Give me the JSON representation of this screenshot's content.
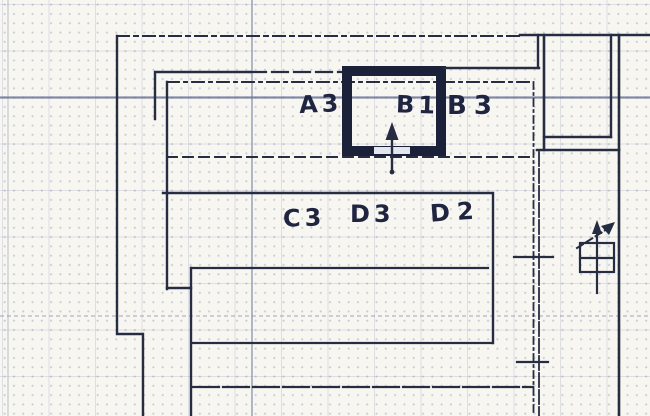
{
  "document": {
    "kind_note": "hand-drawn floor plan on graph paper"
  },
  "rooms": {
    "a3": {
      "label": "A3"
    },
    "b1": {
      "label": "B1"
    },
    "b3": {
      "label": "B3"
    },
    "c3": {
      "label": "C3"
    },
    "d3": {
      "label": "D3"
    },
    "d2": {
      "label": "D2"
    }
  },
  "symbols": {
    "b1_entry_arrow": "up-arrow",
    "stair_direction_arrow": "up-right-arrow",
    "stair_run_arrow": "up-arrow"
  },
  "colors": {
    "ink": "#262c42",
    "bold_wall": "#1b2138",
    "paper": "#f7f6f1",
    "grid_fine": "#c7ccda",
    "grid_strong": "#6872a0",
    "label_ink": "#1f2540"
  }
}
